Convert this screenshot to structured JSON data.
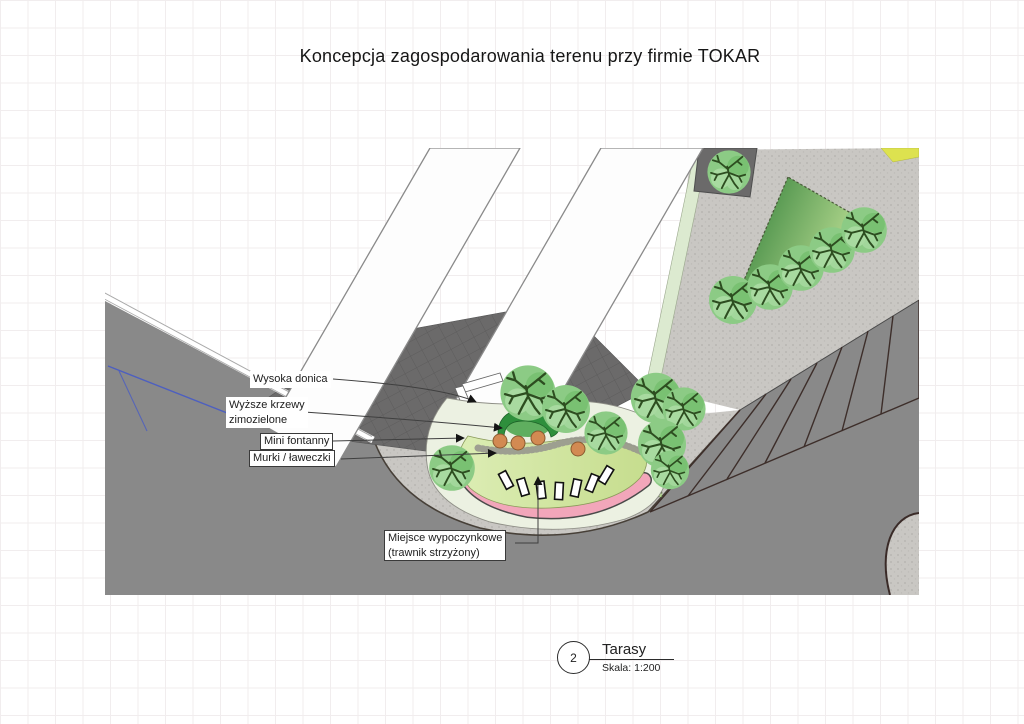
{
  "title": "Koncepcja zagospodarowania terenu przy firmie TOKAR",
  "annotations": {
    "wysoka_donica": "Wysoka donica",
    "wyzsze_krzewy": {
      "line1": "Wyższe krzewy",
      "line2": "zimozielone"
    },
    "mini_fontanny": "Mini fontanny",
    "murki_laweczki": "Murki / ławeczki",
    "miejsce": {
      "line1": "Miejsce wypoczynkowe",
      "line2": "(trawnik strzyżony)"
    }
  },
  "title_block": {
    "number": "2",
    "name": "Tarasy",
    "scale": "Skala: 1:200"
  },
  "palette": {
    "ground_gray": "#898989",
    "pavement_light": "#c9c7c3",
    "yard_dark": "#6b6a6a",
    "tree_green": "#8ccb85",
    "lawn_green": "#d5e79f",
    "bench_wall_pink": "#f2a6ba",
    "fountain_orange": "#d28a52",
    "evergreen_dark": "#2e8f3c",
    "island_green": "#2f7d37",
    "boundary_blue": "#4d5fc0",
    "accent_yellow": "#dde24f"
  }
}
